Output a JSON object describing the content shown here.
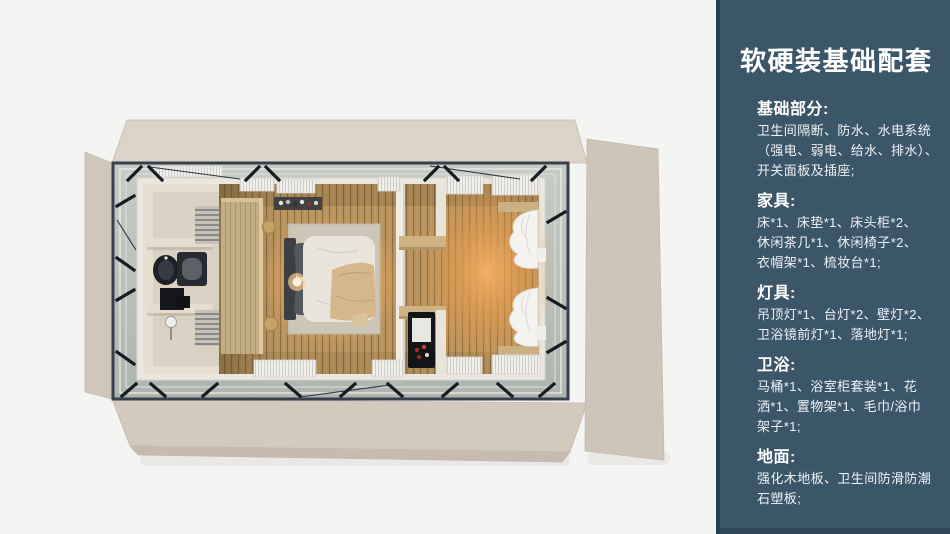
{
  "panel": {
    "title": "软硬装基础配套",
    "sections": [
      {
        "heading": "基础部分:",
        "lines": [
          "卫生间隔断、防水、水电系统",
          "（强电、弱电、给水、排水）、",
          "开关面板及插座;"
        ]
      },
      {
        "heading": "家具:",
        "lines": [
          "床*1、床垫*1、床头柜*2、",
          "休闲茶几*1、休闲椅子*2、",
          "衣帽架*1、梳妆台*1;"
        ]
      },
      {
        "heading": "灯具:",
        "lines": [
          "吊顶灯*1、台灯*2、壁灯*2、",
          "卫浴镜前灯*1、落地灯*1;"
        ]
      },
      {
        "heading": "卫浴:",
        "lines": [
          "马桶*1、浴室柜套装*1、花",
          "洒*1、置物架*1、毛巾/浴巾",
          "架子*1;"
        ]
      },
      {
        "heading": "地面:",
        "lines": [
          "强化木地板、卫生间防滑防潮",
          "石塑板;"
        ]
      }
    ]
  },
  "colors": {
    "page_bg": "#f4f4f2",
    "sidebar_bg": "#3c5669",
    "sidebar_border": "#224257",
    "text": "#ffffff",
    "exterior_wall": "#d6ccc1",
    "floor_wood": "#b8935e",
    "warm_glow": "#f0a85e",
    "steel_frame": "#37404d"
  }
}
